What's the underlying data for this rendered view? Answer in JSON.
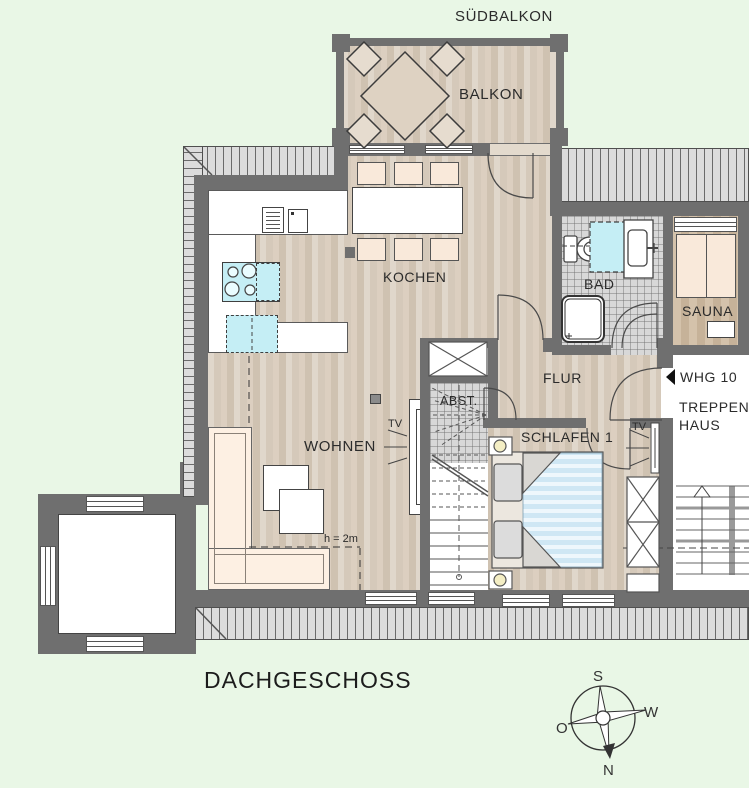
{
  "floorplan": {
    "title": "DACHGESCHOSS",
    "labels": {
      "suedbalkon": "SÜDBALKON",
      "balkon": "BALKON",
      "kochen": "KOCHEN",
      "wohnen": "WOHNEN",
      "bad": "BAD",
      "sauna": "SAUNA",
      "flur": "FLUR",
      "abstellraum": "ABST.",
      "schlafen": "SCHLAFEN 1",
      "treppenhaus_line1": "TREPPEN-",
      "treppenhaus_line2": "HAUS",
      "whg": "WHG 10",
      "tv": "TV",
      "height_line": "h = 2m"
    },
    "compass": {
      "north": "N",
      "south": "S",
      "east_o": "O",
      "west": "W"
    },
    "colors": {
      "background": "#e9f7e6",
      "wall": "#6f6f6f",
      "roof_hatch": "#dcdcdc",
      "wood_floor": "#d9cec1",
      "tile_floor": "#d8d8d8",
      "fixture_cyan": "#c5eef5",
      "furniture_peach": "#f9e9da",
      "sofa_cream": "#fdf0e3",
      "bed_blue": "#cfe7f4",
      "lamp_yellow": "#f4eec4"
    }
  }
}
